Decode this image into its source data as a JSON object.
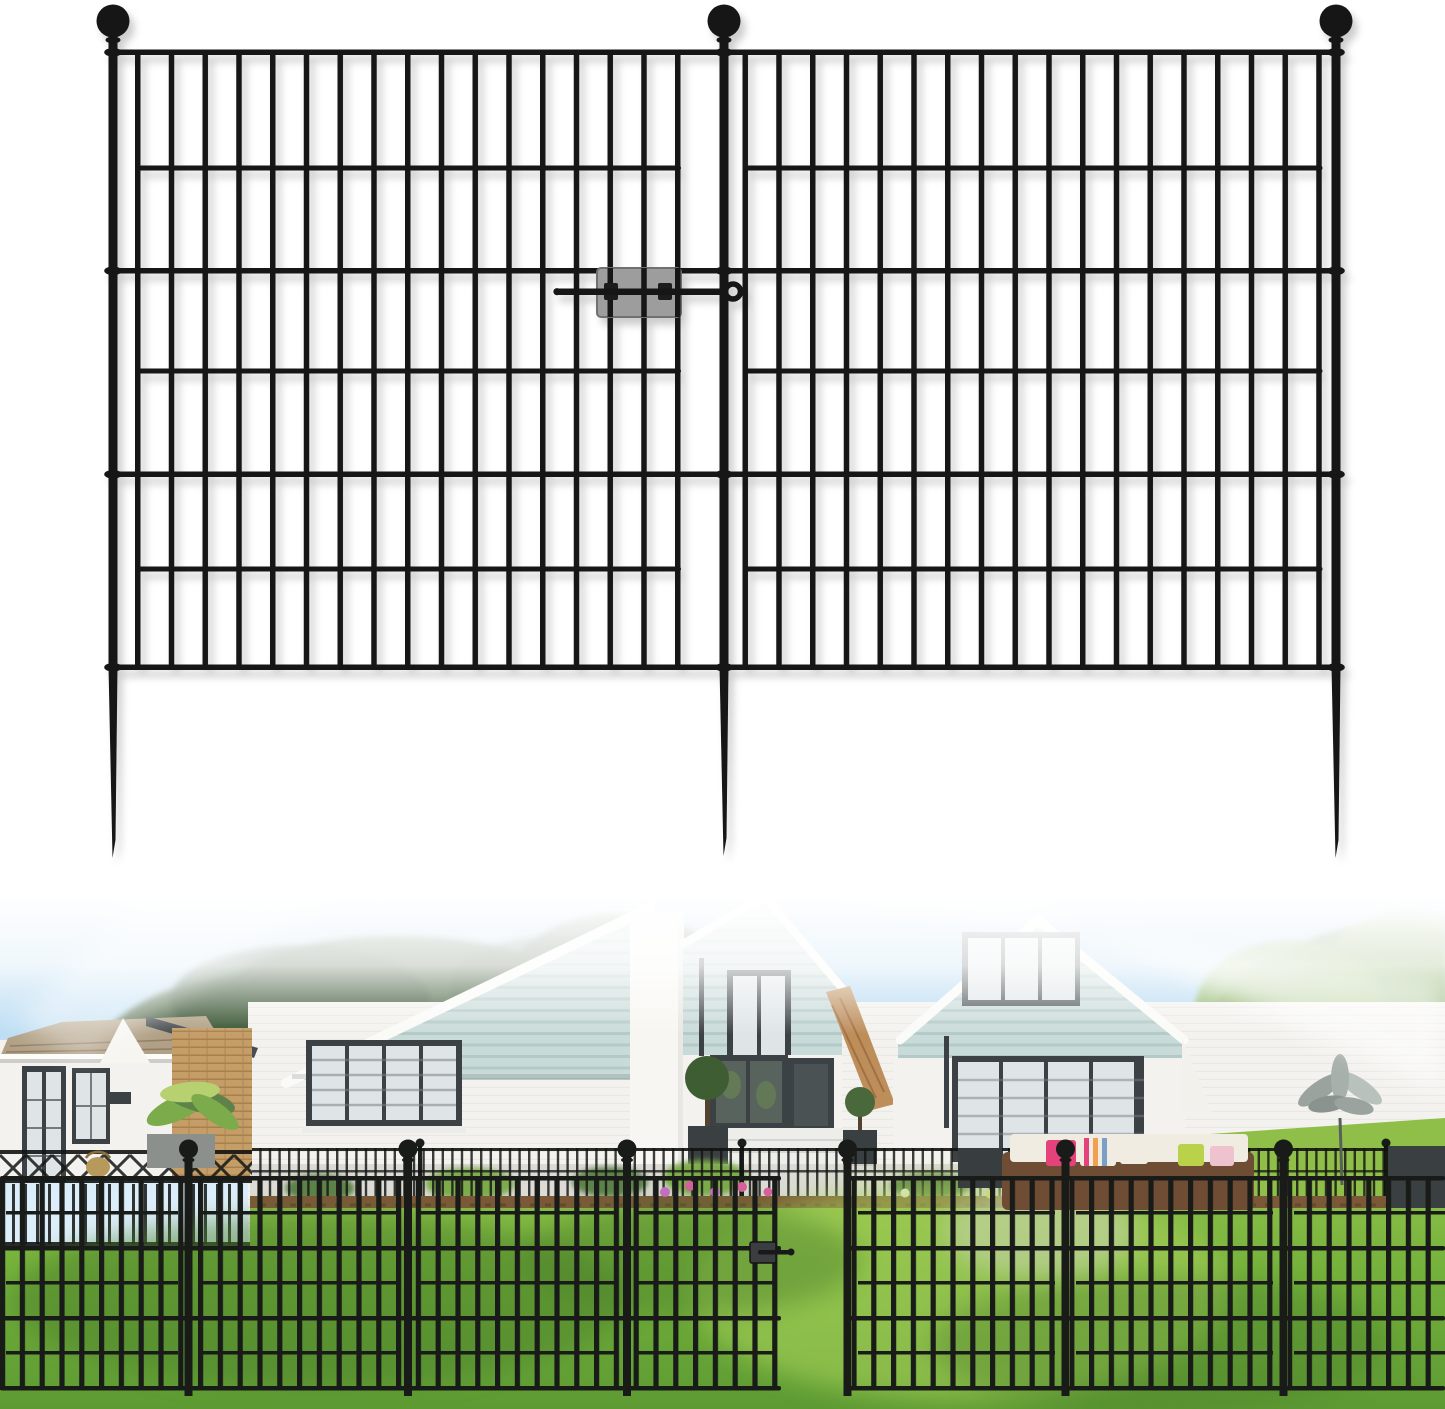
{
  "image": {
    "kind": "e-commerce product image",
    "subject": "black no-dig metal garden fence panels with gate latch",
    "width_px": 1445,
    "height_px": 1409
  },
  "colors": {
    "bg": "#ffffff",
    "fence": "#141414",
    "fencePhoto": "#181b18",
    "latchPlate": "#9d9d9d",
    "latchBorder": "#6f6f6f",
    "latchClip": "#1c1c1c",
    "skyTop": "#a3cfee",
    "skyLow": "#dceefa",
    "treeDark": "#44613d",
    "treeDarker": "#344f2e",
    "treeMid": "#5d824a",
    "treeBright": "#7cab4b",
    "treeYellow": "#b7d070",
    "roofTan": "#b1a085",
    "wallWhite": "#f3f2ee",
    "brick": "#c49d67",
    "siding": "#c9dbd9",
    "sidingLine": "#b0c8c6",
    "frameDark": "#3b4144",
    "glass": "#dfe5e7",
    "glassDark": "#57635c",
    "chimney": "#f7f6f2",
    "lawnLight": "#93c44c",
    "lawn": "#74b13b",
    "lawnDeep": "#5d9a33",
    "lawnShadow": "#4c7f2c",
    "mulch": "#7b5938",
    "planter": "#3a3f41",
    "planterGray": "#8b908c",
    "wicker": "#6f4c34",
    "cushion": "#f0ece1",
    "pillowPink": "#e5417a",
    "pillowLime": "#b9d24a",
    "pillowOrange": "#f0a04e",
    "basket": "#b8995c",
    "pathLight": "#d6d7c8",
    "terrace": "#d9d8d1",
    "silver": "#9aa39e"
  },
  "product_render": {
    "panels": 2,
    "posts_with_ball_finials": 3,
    "ground_spikes": 3,
    "rails_per_panel": 7,
    "rail_style": "alternating full-width and inset rails",
    "vertical_bars_left_panel": 17,
    "vertical_bars_right_panel": 18,
    "connector": "gray gate-latch plate with sliding rod hooked around center post"
  },
  "photo_scene": {
    "setting": "white brick house with pale blue-green gable siding, lawn and trees",
    "elements": [
      "blue sky",
      "dark background trees",
      "bright right-side trees",
      "single-story annex with tan shingle roof",
      "three siding gables",
      "dark framed windows and french doors",
      "topiary planters",
      "patio sofa with colorful pillows",
      "metal plant sculpture",
      "thin mid-ground fence with flower bed",
      "bright green lawn with tree shadows",
      "foreground installed fence with open gate and latch"
    ]
  }
}
